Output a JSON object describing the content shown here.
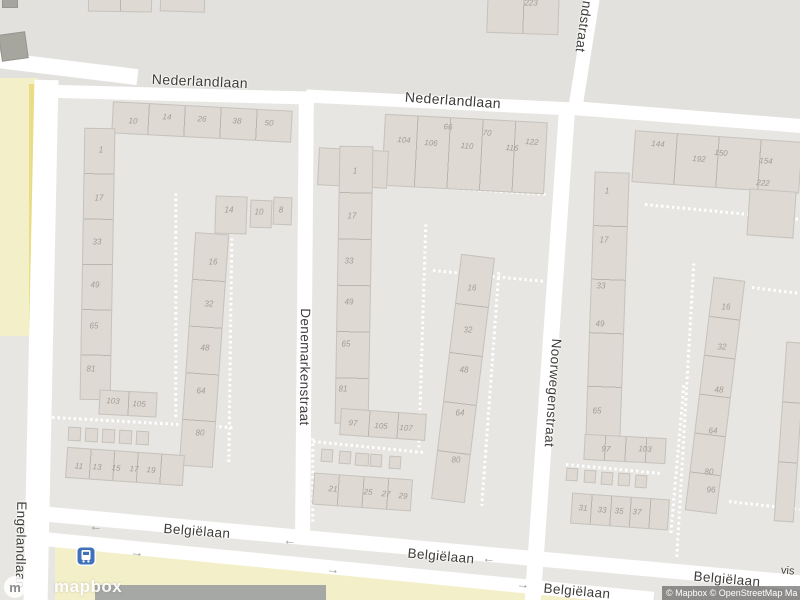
{
  "map_ui": {
    "logo": {
      "word": "mapbox",
      "mark": "m"
    },
    "attribution": {
      "text": "© Mapbox © OpenStreetMap Ma"
    },
    "partial_poi_label": "vis",
    "transit_icon": "bus-stop"
  },
  "colors": {
    "base": "#e8e6e2",
    "north_block": "#e3e1de",
    "road": "#ffffff",
    "building": "#ded9d3",
    "building_outline": "#c6c2bc",
    "building_dark": "#a6a69f",
    "yellow_pale": "#f3efc8",
    "yellow_bright": "#eadd85",
    "dark_roof": "#a5a8a4",
    "street_text": "#3e3c39",
    "number_text": "#a19c95",
    "transit_blue": "#3f72b8"
  },
  "areas": [
    {
      "name": "block-north",
      "fill": "#e3e1de",
      "poly": [
        [
          0,
          0
        ],
        [
          800,
          0
        ],
        [
          800,
          128
        ],
        [
          572,
          110
        ],
        [
          308,
          97
        ],
        [
          35,
          90
        ],
        [
          0,
          86
        ]
      ]
    },
    {
      "name": "field-yellow-left",
      "fill": "#f3efc8",
      "poly": [
        [
          0,
          78
        ],
        [
          38,
          78
        ],
        [
          38,
          336
        ],
        [
          0,
          336
        ]
      ]
    },
    {
      "name": "path-yellow-left",
      "fill": "#eadd85",
      "poly": [
        [
          29,
          84
        ],
        [
          35,
          84
        ],
        [
          35,
          336
        ],
        [
          29,
          336
        ]
      ]
    },
    {
      "name": "field-yellow-bottom",
      "fill": "#f3efc8",
      "poly": [
        [
          55,
          541
        ],
        [
          120,
          550
        ],
        [
          592,
          596
        ],
        [
          592,
          600
        ],
        [
          55,
          600
        ]
      ]
    },
    {
      "name": "roof-dark-bottom",
      "fill": "#a5a8a4",
      "poly": [
        [
          95,
          585
        ],
        [
          326,
          585
        ],
        [
          326,
          600
        ],
        [
          95,
          600
        ]
      ]
    }
  ],
  "roads": [
    {
      "x": -12,
      "y": 60,
      "w": 150,
      "h": 16,
      "rot": 7
    },
    {
      "x": 35,
      "y": 88,
      "w": 278,
      "h": 13,
      "rot": 1.5
    },
    {
      "x": 306,
      "y": 96,
      "w": 268,
      "h": 13,
      "rot": 2.8
    },
    {
      "x": 570,
      "y": 110,
      "w": 234,
      "h": 14,
      "rot": 4.5
    },
    {
      "x": 29,
      "y": 80,
      "w": 24,
      "h": 522,
      "rot": 1.2
    },
    {
      "x": 297,
      "y": 94,
      "w": 15,
      "h": 440,
      "rot": 0.5
    },
    {
      "x": 542,
      "y": 103,
      "w": 16,
      "h": 500,
      "rot": 4
    },
    {
      "x": 578,
      "y": -12,
      "w": 14,
      "h": 118,
      "rot": 9
    },
    {
      "x": 17,
      "y": 540,
      "w": 792,
      "h": 15,
      "rot": 5.2
    },
    {
      "x": 43,
      "y": 562,
      "w": 612,
      "h": 14,
      "rot": 5.6
    }
  ],
  "footpaths": [
    {
      "x1": 42,
      "y1": 100,
      "x2": 40,
      "y2": 530
    },
    {
      "x1": 36,
      "y1": 416,
      "x2": 233,
      "y2": 427
    },
    {
      "x1": 176,
      "y1": 193,
      "x2": 176,
      "y2": 420
    },
    {
      "x1": 232,
      "y1": 238,
      "x2": 229,
      "y2": 462
    },
    {
      "x1": 333,
      "y1": 180,
      "x2": 548,
      "y2": 194
    },
    {
      "x1": 426,
      "y1": 224,
      "x2": 419,
      "y2": 447
    },
    {
      "x1": 433,
      "y1": 270,
      "x2": 545,
      "y2": 281
    },
    {
      "x1": 499,
      "y1": 272,
      "x2": 482,
      "y2": 505
    },
    {
      "x1": 313,
      "y1": 438,
      "x2": 313,
      "y2": 522
    },
    {
      "x1": 313,
      "y1": 441,
      "x2": 423,
      "y2": 452
    },
    {
      "x1": 554,
      "y1": 213,
      "x2": 546,
      "y2": 420
    },
    {
      "x1": 645,
      "y1": 204,
      "x2": 800,
      "y2": 219
    },
    {
      "x1": 694,
      "y1": 263,
      "x2": 677,
      "y2": 557
    },
    {
      "x1": 752,
      "y1": 287,
      "x2": 800,
      "y2": 293
    },
    {
      "x1": 684,
      "y1": 385,
      "x2": 671,
      "y2": 534
    },
    {
      "x1": 729,
      "y1": 501,
      "x2": 800,
      "y2": 509
    },
    {
      "x1": 566,
      "y1": 464,
      "x2": 662,
      "y2": 473
    }
  ],
  "buildings": [
    {
      "x": 112,
      "y": 106,
      "w": 180,
      "h": 32,
      "rot": 3,
      "units": 5,
      "dir": "h"
    },
    {
      "x": 82,
      "y": 128,
      "w": 31,
      "h": 272,
      "rot": 1,
      "units": 6,
      "dir": "v"
    },
    {
      "x": 215,
      "y": 196,
      "w": 32,
      "h": 38,
      "rot": 2,
      "units": 1,
      "dir": "h"
    },
    {
      "x": 250,
      "y": 200,
      "w": 22,
      "h": 28,
      "rot": 2,
      "units": 1,
      "dir": "h"
    },
    {
      "x": 273,
      "y": 197,
      "w": 19,
      "h": 28,
      "rot": 2,
      "units": 1,
      "dir": "h"
    },
    {
      "x": 187,
      "y": 233,
      "w": 34,
      "h": 234,
      "rot": 4,
      "units": 5,
      "dir": "v"
    },
    {
      "x": 99,
      "y": 391,
      "w": 58,
      "h": 25,
      "rot": 3,
      "units": 2,
      "dir": "h"
    },
    {
      "x": 68,
      "y": 427,
      "w": 13,
      "h": 14,
      "rot": 3,
      "units": 1,
      "dir": "h"
    },
    {
      "x": 85,
      "y": 428,
      "w": 13,
      "h": 14,
      "rot": 3,
      "units": 1,
      "dir": "h"
    },
    {
      "x": 102,
      "y": 429,
      "w": 13,
      "h": 14,
      "rot": 3,
      "units": 1,
      "dir": "h"
    },
    {
      "x": 119,
      "y": 430,
      "w": 13,
      "h": 14,
      "rot": 3,
      "units": 1,
      "dir": "h"
    },
    {
      "x": 136,
      "y": 431,
      "w": 13,
      "h": 14,
      "rot": 3,
      "units": 1,
      "dir": "h"
    },
    {
      "x": 66,
      "y": 451,
      "w": 118,
      "h": 31,
      "rot": 4,
      "units": 5,
      "dir": "h"
    },
    {
      "x": 383,
      "y": 118,
      "w": 163,
      "h": 72,
      "rot": 3,
      "units": 5,
      "dir": "h"
    },
    {
      "x": 318,
      "y": 149,
      "w": 70,
      "h": 38,
      "rot": 3,
      "units": 2,
      "dir": "h"
    },
    {
      "x": 337,
      "y": 146,
      "w": 34,
      "h": 278,
      "rot": 1,
      "units": 6,
      "dir": "v"
    },
    {
      "x": 340,
      "y": 411,
      "w": 86,
      "h": 27,
      "rot": 4,
      "units": 3,
      "dir": "h"
    },
    {
      "x": 321,
      "y": 449,
      "w": 12,
      "h": 13,
      "rot": 4,
      "units": 1,
      "dir": "h"
    },
    {
      "x": 339,
      "y": 451,
      "w": 12,
      "h": 13,
      "rot": 4,
      "units": 1,
      "dir": "h"
    },
    {
      "x": 355,
      "y": 453,
      "w": 14,
      "h": 13,
      "rot": 4,
      "units": 1,
      "dir": "h"
    },
    {
      "x": 370,
      "y": 454,
      "w": 12,
      "h": 13,
      "rot": 4,
      "units": 1,
      "dir": "h"
    },
    {
      "x": 389,
      "y": 456,
      "w": 12,
      "h": 13,
      "rot": 4,
      "units": 1,
      "dir": "h"
    },
    {
      "x": 313,
      "y": 476,
      "w": 99,
      "h": 32,
      "rot": 4,
      "units": 4,
      "dir": "h"
    },
    {
      "x": 446,
      "y": 255,
      "w": 34,
      "h": 247,
      "rot": 7,
      "units": 5,
      "dir": "v"
    },
    {
      "x": 633,
      "y": 136,
      "w": 168,
      "h": 52,
      "rot": 4,
      "units": 4,
      "dir": "h"
    },
    {
      "x": 748,
      "y": 190,
      "w": 47,
      "h": 47,
      "rot": 4,
      "units": 1,
      "dir": "h"
    },
    {
      "x": 590,
      "y": 172,
      "w": 35,
      "h": 268,
      "rot": 2,
      "units": 5,
      "dir": "v"
    },
    {
      "x": 584,
      "y": 436,
      "w": 82,
      "h": 26,
      "rot": 3,
      "units": 4,
      "dir": "h"
    },
    {
      "x": 566,
      "y": 468,
      "w": 12,
      "h": 13,
      "rot": 4,
      "units": 1,
      "dir": "h"
    },
    {
      "x": 584,
      "y": 470,
      "w": 12,
      "h": 13,
      "rot": 4,
      "units": 1,
      "dir": "h"
    },
    {
      "x": 601,
      "y": 472,
      "w": 12,
      "h": 13,
      "rot": 4,
      "units": 1,
      "dir": "h"
    },
    {
      "x": 618,
      "y": 473,
      "w": 12,
      "h": 13,
      "rot": 4,
      "units": 1,
      "dir": "h"
    },
    {
      "x": 635,
      "y": 475,
      "w": 12,
      "h": 13,
      "rot": 4,
      "units": 1,
      "dir": "h"
    },
    {
      "x": 571,
      "y": 496,
      "w": 98,
      "h": 31,
      "rot": 4,
      "units": 5,
      "dir": "h"
    },
    {
      "x": 699,
      "y": 278,
      "w": 32,
      "h": 235,
      "rot": 7,
      "units": 6,
      "dir": "v"
    },
    {
      "x": 780,
      "y": 342,
      "w": 20,
      "h": 180,
      "rot": 4,
      "units": 3,
      "dir": "v"
    },
    {
      "x": 487,
      "y": -8,
      "w": 72,
      "h": 42,
      "rot": 2,
      "units": 2,
      "dir": "h"
    },
    {
      "x": 88,
      "y": -6,
      "w": 64,
      "h": 18,
      "rot": 1,
      "units": 2,
      "dir": "h"
    },
    {
      "x": 160,
      "y": -4,
      "w": 45,
      "h": 16,
      "rot": 2,
      "units": 1,
      "dir": "h"
    },
    {
      "x": 0,
      "y": 33,
      "w": 27,
      "h": 27,
      "rot": -8,
      "units": 1,
      "dir": "h",
      "dark": true
    },
    {
      "x": 2,
      "y": -4,
      "w": 16,
      "h": 12,
      "rot": 0,
      "units": 1,
      "dir": "h",
      "dark": true
    }
  ],
  "house_numbers": [
    {
      "t": "10",
      "x": 133,
      "y": 121,
      "rot": 3
    },
    {
      "t": "14",
      "x": 167,
      "y": 117,
      "rot": 3
    },
    {
      "t": "26",
      "x": 202,
      "y": 119,
      "rot": 3
    },
    {
      "t": "38",
      "x": 237,
      "y": 121,
      "rot": 3
    },
    {
      "t": "50",
      "x": 269,
      "y": 123,
      "rot": 3
    },
    {
      "t": "1",
      "x": 101,
      "y": 150,
      "rot": 0
    },
    {
      "t": "17",
      "x": 99,
      "y": 198,
      "rot": 0
    },
    {
      "t": "33",
      "x": 97,
      "y": 242,
      "rot": 0
    },
    {
      "t": "49",
      "x": 95,
      "y": 285,
      "rot": 0
    },
    {
      "t": "65",
      "x": 94,
      "y": 326,
      "rot": 0
    },
    {
      "t": "81",
      "x": 91,
      "y": 369,
      "rot": 0
    },
    {
      "t": "14",
      "x": 229,
      "y": 210,
      "rot": 0
    },
    {
      "t": "10",
      "x": 259,
      "y": 212,
      "rot": 0
    },
    {
      "t": "8",
      "x": 281,
      "y": 210,
      "rot": 0
    },
    {
      "t": "16",
      "x": 213,
      "y": 262,
      "rot": 0
    },
    {
      "t": "32",
      "x": 209,
      "y": 304,
      "rot": 0
    },
    {
      "t": "48",
      "x": 205,
      "y": 348,
      "rot": 0
    },
    {
      "t": "64",
      "x": 201,
      "y": 391,
      "rot": 0
    },
    {
      "t": "80",
      "x": 200,
      "y": 433,
      "rot": 0
    },
    {
      "t": "103",
      "x": 113,
      "y": 401,
      "rot": 3
    },
    {
      "t": "105",
      "x": 139,
      "y": 404,
      "rot": 3
    },
    {
      "t": "11",
      "x": 79,
      "y": 466,
      "rot": 4
    },
    {
      "t": "13",
      "x": 97,
      "y": 467,
      "rot": 4
    },
    {
      "t": "15",
      "x": 116,
      "y": 468,
      "rot": 4
    },
    {
      "t": "17",
      "x": 134,
      "y": 469,
      "rot": 4
    },
    {
      "t": "19",
      "x": 151,
      "y": 470,
      "rot": 4
    },
    {
      "t": "104",
      "x": 404,
      "y": 140,
      "rot": 4
    },
    {
      "t": "106",
      "x": 431,
      "y": 143,
      "rot": 4
    },
    {
      "t": "66",
      "x": 448,
      "y": 127,
      "rot": 4
    },
    {
      "t": "110",
      "x": 467,
      "y": 146,
      "rot": 4
    },
    {
      "t": "70",
      "x": 487,
      "y": 133,
      "rot": 4
    },
    {
      "t": "116",
      "x": 512,
      "y": 148,
      "rot": 4
    },
    {
      "t": "122",
      "x": 532,
      "y": 142,
      "rot": 4
    },
    {
      "t": "1",
      "x": 355,
      "y": 171,
      "rot": 0
    },
    {
      "t": "17",
      "x": 352,
      "y": 216,
      "rot": 0
    },
    {
      "t": "33",
      "x": 349,
      "y": 261,
      "rot": 0
    },
    {
      "t": "49",
      "x": 349,
      "y": 302,
      "rot": 0
    },
    {
      "t": "65",
      "x": 346,
      "y": 344,
      "rot": 0
    },
    {
      "t": "81",
      "x": 343,
      "y": 389,
      "rot": 0
    },
    {
      "t": "97",
      "x": 353,
      "y": 423,
      "rot": 4
    },
    {
      "t": "105",
      "x": 381,
      "y": 426,
      "rot": 4
    },
    {
      "t": "107",
      "x": 406,
      "y": 428,
      "rot": 4
    },
    {
      "t": "21",
      "x": 333,
      "y": 489,
      "rot": 4
    },
    {
      "t": "25",
      "x": 368,
      "y": 492,
      "rot": 4
    },
    {
      "t": "27",
      "x": 386,
      "y": 494,
      "rot": 4
    },
    {
      "t": "29",
      "x": 403,
      "y": 496,
      "rot": 4
    },
    {
      "t": "16",
      "x": 472,
      "y": 288,
      "rot": 0
    },
    {
      "t": "32",
      "x": 468,
      "y": 330,
      "rot": 0
    },
    {
      "t": "48",
      "x": 464,
      "y": 370,
      "rot": 0
    },
    {
      "t": "64",
      "x": 460,
      "y": 413,
      "rot": 0
    },
    {
      "t": "80",
      "x": 456,
      "y": 460,
      "rot": 0
    },
    {
      "t": "144",
      "x": 658,
      "y": 144,
      "rot": 4
    },
    {
      "t": "192",
      "x": 699,
      "y": 159,
      "rot": 4
    },
    {
      "t": "150",
      "x": 721,
      "y": 153,
      "rot": 4
    },
    {
      "t": "154",
      "x": 766,
      "y": 161,
      "rot": 4
    },
    {
      "t": "222",
      "x": 763,
      "y": 183,
      "rot": 4
    },
    {
      "t": "1",
      "x": 607,
      "y": 191,
      "rot": 0
    },
    {
      "t": "17",
      "x": 604,
      "y": 240,
      "rot": 0
    },
    {
      "t": "33",
      "x": 601,
      "y": 286,
      "rot": 0
    },
    {
      "t": "49",
      "x": 600,
      "y": 324,
      "rot": 0
    },
    {
      "t": "65",
      "x": 597,
      "y": 411,
      "rot": 0
    },
    {
      "t": "97",
      "x": 606,
      "y": 449,
      "rot": 3
    },
    {
      "t": "103",
      "x": 645,
      "y": 449,
      "rot": 3
    },
    {
      "t": "31",
      "x": 583,
      "y": 508,
      "rot": 4
    },
    {
      "t": "33",
      "x": 602,
      "y": 510,
      "rot": 4
    },
    {
      "t": "35",
      "x": 619,
      "y": 511,
      "rot": 4
    },
    {
      "t": "37",
      "x": 637,
      "y": 512,
      "rot": 4
    },
    {
      "t": "16",
      "x": 726,
      "y": 307,
      "rot": 0
    },
    {
      "t": "32",
      "x": 722,
      "y": 347,
      "rot": 0
    },
    {
      "t": "48",
      "x": 719,
      "y": 390,
      "rot": 0
    },
    {
      "t": "64",
      "x": 713,
      "y": 431,
      "rot": 0
    },
    {
      "t": "80",
      "x": 709,
      "y": 472,
      "rot": 0
    },
    {
      "t": "96",
      "x": 711,
      "y": 490,
      "rot": 0
    },
    {
      "t": "223",
      "x": 531,
      "y": 3,
      "rot": 0
    }
  ],
  "street_labels": [
    {
      "name": "street-label-nederlandlaan-west",
      "text": "Nederlandlaan",
      "x": 200,
      "y": 81,
      "rot": 2.5,
      "size": 14
    },
    {
      "name": "street-label-nederlandlaan-east",
      "text": "Nederlandlaan",
      "x": 453,
      "y": 100,
      "rot": 4,
      "size": 14
    },
    {
      "name": "street-label-denemarkenstraat",
      "text": "Denemarkenstraat",
      "x": 305,
      "y": 367,
      "rot": 90.5,
      "size": 13.5
    },
    {
      "name": "street-label-noorwegenstraat",
      "text": "Noorwegenstraat",
      "x": 553,
      "y": 393,
      "rot": 94,
      "size": 13.5
    },
    {
      "name": "street-label-schotlandstraat",
      "text": "Schotlandstraat",
      "x": 587,
      "y": 3,
      "rot": 98,
      "size": 13.5
    },
    {
      "name": "street-label-engelandlaan",
      "text": "Engelandlaan",
      "x": 21,
      "y": 545,
      "rot": 91,
      "size": 13.5
    },
    {
      "name": "street-label-belgielaan-1",
      "text": "Belgiëlaan",
      "x": 197,
      "y": 531,
      "rot": 4.5,
      "size": 13.5
    },
    {
      "name": "street-label-belgielaan-2",
      "text": "Belgiëlaan",
      "x": 441,
      "y": 556,
      "rot": 5,
      "size": 13.5
    },
    {
      "name": "street-label-belgielaan-3",
      "text": "Belgiëlaan",
      "x": 727,
      "y": 579,
      "rot": 5,
      "size": 13.5
    },
    {
      "name": "street-label-belgielaan-4",
      "text": "Belgiëlaan",
      "x": 577,
      "y": 591,
      "rot": 5,
      "size": 13.5
    }
  ],
  "oneway_arrows": [
    {
      "g": "←",
      "x": 96,
      "y": 526,
      "rot": 5
    },
    {
      "g": "→",
      "x": 137,
      "y": 552,
      "rot": 5
    },
    {
      "g": "←",
      "x": 290,
      "y": 540,
      "rot": 5
    },
    {
      "g": "→",
      "x": 333,
      "y": 569,
      "rot": 5
    },
    {
      "g": "←",
      "x": 489,
      "y": 558,
      "rot": 5
    },
    {
      "g": "→",
      "x": 523,
      "y": 584,
      "rot": 5
    }
  ]
}
